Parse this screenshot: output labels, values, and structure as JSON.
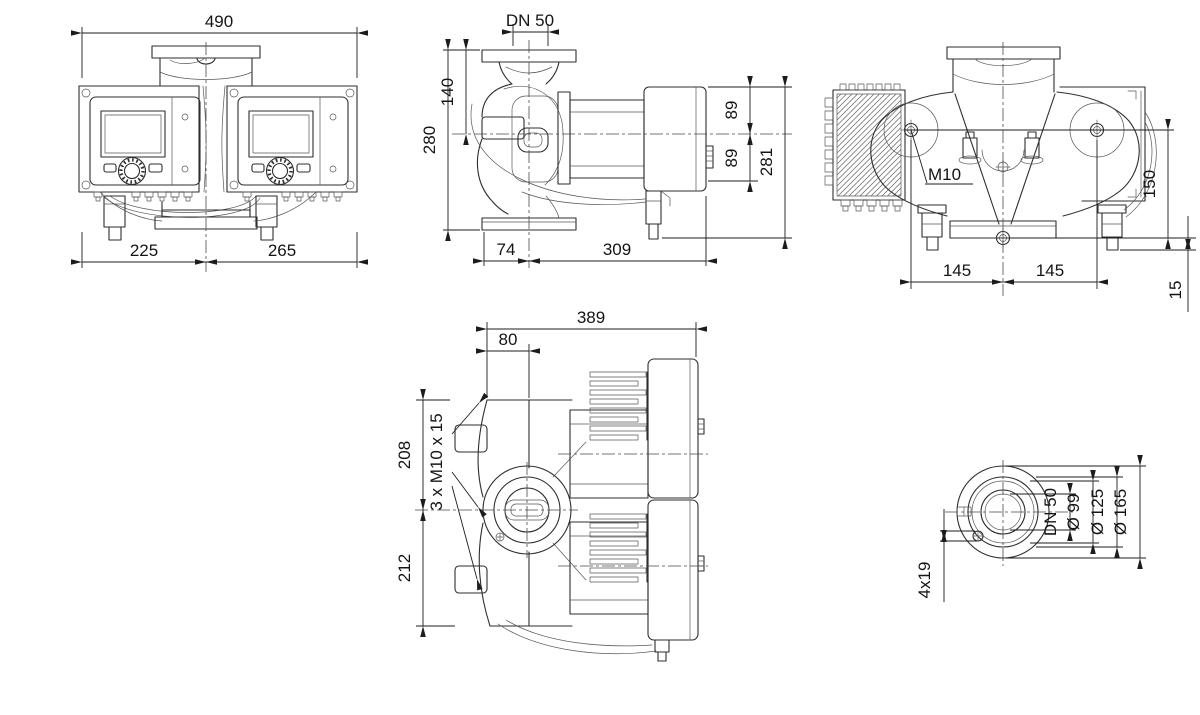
{
  "front": {
    "width_total": "490",
    "width_left": "225",
    "width_right": "265"
  },
  "side": {
    "dn": "DN 50",
    "flange_to_axis": "140",
    "port_to_port": "280",
    "axis_to_flange": "74",
    "axis_to_module_end": "309",
    "axis_up": "89",
    "axis_down": "89",
    "height_total": "281"
  },
  "bottom": {
    "thread": "M10",
    "pitch_left": "145",
    "pitch_right": "145",
    "height": "150",
    "offset": "15"
  },
  "top": {
    "length_total": "389",
    "flange_face": "80",
    "depth_upper": "208",
    "depth_lower": "212",
    "flange_bolts": "3 x M10 x 15"
  },
  "flange": {
    "holes": "4x19",
    "dn": "DN 50",
    "d_hub": "Ø 99",
    "d_bolt_circle": "Ø 125",
    "d_outer": "Ø 165"
  }
}
